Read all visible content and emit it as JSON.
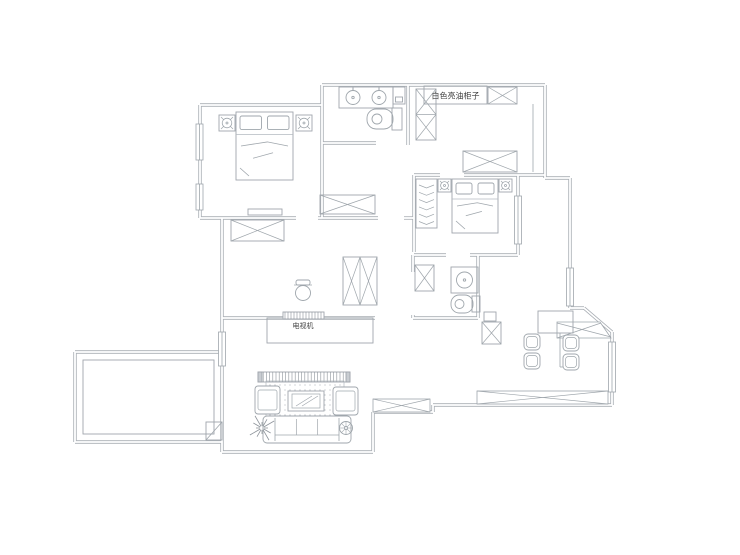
{
  "labels": {
    "cabinet": "白色亮油柜子",
    "tv_wall": "电视机"
  },
  "colors": {
    "bg": "#ffffff",
    "wall": "#a9aeb4",
    "line": "#9fa6ac",
    "soft": "#b4bac0",
    "dark": "#8d939a",
    "text": "#3f3f3f"
  },
  "plan": {
    "walls": [
      [
        200,
        105,
        322,
        105
      ],
      [
        322,
        85,
        322,
        105
      ],
      [
        322,
        85,
        545,
        85
      ],
      [
        545,
        85,
        545,
        178
      ],
      [
        545,
        178,
        570,
        178
      ],
      [
        570,
        178,
        570,
        308
      ],
      [
        570,
        308,
        584,
        308
      ],
      [
        584,
        308,
        612,
        332
      ],
      [
        612,
        332,
        612,
        405
      ],
      [
        433,
        405,
        612,
        405
      ],
      [
        433,
        405,
        433,
        412
      ],
      [
        373,
        412,
        433,
        412
      ],
      [
        373,
        412,
        373,
        452
      ],
      [
        222,
        452,
        373,
        452
      ],
      [
        222,
        218,
        222,
        452
      ],
      [
        200,
        105,
        200,
        218
      ],
      [
        200,
        218,
        296,
        218
      ],
      [
        318,
        218,
        322,
        218
      ],
      [
        322,
        105,
        322,
        218
      ],
      [
        322,
        143,
        376,
        143
      ],
      [
        408,
        85,
        408,
        145
      ],
      [
        414,
        175,
        414,
        252
      ],
      [
        414,
        175,
        440,
        175
      ],
      [
        464,
        175,
        545,
        175
      ],
      [
        518,
        175,
        518,
        255
      ],
      [
        414,
        255,
        446,
        255
      ],
      [
        470,
        255,
        518,
        255
      ],
      [
        413,
        255,
        413,
        272
      ],
      [
        413,
        315,
        413,
        318
      ],
      [
        478,
        255,
        478,
        318
      ],
      [
        222,
        318,
        375,
        318
      ],
      [
        413,
        318,
        478,
        318
      ],
      [
        322,
        218,
        378,
        218
      ],
      [
        404,
        218,
        414,
        218
      ],
      [
        75,
        352,
        222,
        352
      ],
      [
        75,
        352,
        75,
        442
      ],
      [
        75,
        442,
        222,
        442
      ]
    ],
    "thin_lines": [
      [
        533,
        104,
        533,
        172
      ],
      [
        560,
        333,
        560,
        367
      ],
      [
        560,
        367,
        573,
        367
      ],
      [
        206,
        440,
        222,
        422
      ]
    ],
    "windows": [
      {
        "x": 196,
        "y": 124,
        "w": 7,
        "h": 36
      },
      {
        "x": 196,
        "y": 184,
        "w": 7,
        "h": 26
      },
      {
        "x": 218.5,
        "y": 332,
        "w": 7,
        "h": 34
      },
      {
        "x": 514.5,
        "y": 196,
        "w": 7,
        "h": 48
      },
      {
        "x": 566.5,
        "y": 268,
        "w": 7,
        "h": 38
      },
      {
        "x": 608.5,
        "y": 342,
        "w": 7,
        "h": 50
      }
    ],
    "xwindows": [
      {
        "x": 373,
        "y": 399,
        "w": 57,
        "h": 13,
        "n": "living-south-window"
      },
      {
        "x": 477,
        "y": 391,
        "w": 131,
        "h": 13,
        "n": "dining-bay-window"
      }
    ],
    "chamfer_window": {
      "pts": "557,322 600,322 611,338 557,338",
      "diags": [
        [
          557,
          338,
          601,
          323
        ],
        [
          557,
          323,
          611,
          337
        ]
      ]
    },
    "xboxes": [
      {
        "x": 488,
        "y": 87,
        "w": 29,
        "h": 17,
        "n": "kitchen-top-cabinet-xbox"
      },
      {
        "x": 416,
        "y": 89,
        "w": 20,
        "h": 51,
        "rows": 2,
        "n": "fridge-xbox"
      },
      {
        "x": 463,
        "y": 151,
        "w": 54,
        "h": 21,
        "n": "kitchen-counter-xbox"
      },
      {
        "x": 320,
        "y": 195,
        "w": 55,
        "h": 19,
        "n": "bath-cabinet-xbox"
      },
      {
        "x": 231,
        "y": 220,
        "w": 53,
        "h": 21,
        "n": "hall-wardrobe-xbox"
      },
      {
        "x": 343,
        "y": 257,
        "w": 34,
        "h": 48,
        "cols": 2,
        "n": "hall-tall-cabinet-xbox"
      },
      {
        "x": 415,
        "y": 265,
        "w": 19,
        "h": 26,
        "n": "shower-xbox"
      },
      {
        "x": 482,
        "y": 322,
        "w": 19,
        "h": 22,
        "n": "dining-cabinet-xbox"
      }
    ],
    "rects": [
      {
        "x": 83,
        "y": 360,
        "w": 131,
        "h": 74,
        "n": "balcony-inner"
      },
      {
        "x": 424,
        "y": 86,
        "w": 63,
        "h": 18,
        "n": "cabinet-label-box"
      },
      {
        "x": 393,
        "y": 87,
        "w": 12,
        "h": 17,
        "n": "appliance-box"
      },
      {
        "x": 395.5,
        "y": 97,
        "w": 7,
        "h": 5,
        "n": "appliance-box-inner"
      },
      {
        "x": 267,
        "y": 318,
        "w": 106,
        "h": 25,
        "n": "tv-niche"
      },
      {
        "x": 248,
        "y": 209,
        "w": 34,
        "h": 6,
        "n": "bed-bench"
      },
      {
        "x": 538,
        "y": 311,
        "w": 35,
        "h": 22,
        "n": "dining-sideboard"
      },
      {
        "x": 484,
        "y": 312,
        "w": 12,
        "h": 9,
        "n": "dining-small-box"
      },
      {
        "x": 206,
        "y": 422,
        "w": 16,
        "h": 18,
        "n": "balcony-door"
      }
    ],
    "beds": [
      {
        "x": 236,
        "y": 112,
        "w": 57,
        "h": 68
      },
      {
        "x": 452,
        "y": 179,
        "w": 46,
        "h": 54
      }
    ],
    "lamp_stands": [
      {
        "x": 219,
        "y": 115,
        "s": 16
      },
      {
        "x": 296,
        "y": 115,
        "s": 16
      },
      {
        "x": 438,
        "y": 179,
        "s": 13
      },
      {
        "x": 499,
        "y": 179,
        "s": 13
      }
    ],
    "wardrobe": {
      "x": 416,
      "y": 179,
      "w": 21,
      "h": 49
    },
    "bath1": {
      "counter": {
        "x": 339,
        "y": 87,
        "w": 54,
        "h": 21
      },
      "sinks": [
        [
          353,
          97.5
        ],
        [
          379,
          97.5
        ]
      ],
      "toilet": {
        "tank": [
          392,
          108,
          10,
          22
        ],
        "bowl": [
          367,
          109,
          26,
          20
        ],
        "inner": [
          377,
          119,
          5
        ]
      }
    },
    "bath2": {
      "sink_sq": {
        "x": 451,
        "y": 267,
        "w": 27,
        "h": 26
      },
      "sink_c": [
        464.5,
        280,
        8
      ],
      "toilet": {
        "tank": [
          472,
          296,
          8,
          16
        ],
        "bowl": [
          451,
          295,
          22,
          18
        ],
        "inner": [
          459.5,
          304,
          4.5
        ]
      }
    },
    "hall": {
      "pot": [
        303,
        293
      ],
      "tv_strip": {
        "x": 283,
        "y": 312,
        "w": 41,
        "h": 7
      },
      "label_pos": [
        303,
        328
      ]
    },
    "cabinet_label_pos": [
      455.5,
      98.5
    ],
    "living": {
      "console": {
        "x": 258,
        "y": 372,
        "w": 92,
        "h": 10
      },
      "rug": {
        "x": 266,
        "y": 381,
        "w": 78,
        "h": 41
      },
      "table": {
        "x": 288,
        "y": 391,
        "w": 36,
        "h": 20
      },
      "armchairs": [
        {
          "x": 255,
          "y": 386,
          "w": 25,
          "h": 28
        },
        {
          "x": 333,
          "y": 387,
          "w": 25,
          "h": 28
        }
      ],
      "sofa": {
        "x": 263,
        "y": 416,
        "w": 88,
        "h": 27
      },
      "plant": [
        262,
        428
      ],
      "lamp": [
        346,
        428
      ]
    },
    "dining": {
      "chair_s": 16,
      "chairs": [
        {
          "x": 524,
          "y": 334
        },
        {
          "x": 524,
          "y": 353
        },
        {
          "x": 563,
          "y": 335
        },
        {
          "x": 563,
          "y": 354
        }
      ]
    }
  }
}
